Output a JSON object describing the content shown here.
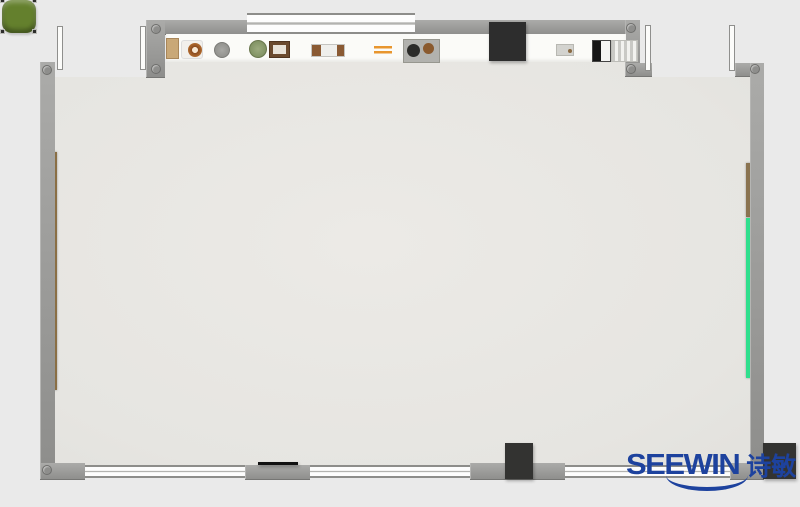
{
  "logo": {
    "text": "SEEWIN",
    "cn": "诗敏",
    "color": "#1d429e"
  },
  "palette": {
    "outside": "#eaeaea",
    "floor": "#e8e7e3",
    "wall": "#9a9a98",
    "window": "#fdfdfd",
    "shelf": "#fbfbf8",
    "cabinet": "#2d2d2d",
    "pillar": "#333331",
    "chair_green": "#64802d",
    "chair_blue": "#5886b5",
    "desk_beige": "#e6cfa7",
    "desk_white": "#f8f8f5",
    "board_brown": "#8a6f45",
    "board_green": "#2fdf8d",
    "l_desk_line": "#c9923f"
  },
  "structure": {
    "floor": {
      "x": 55,
      "y": 58,
      "w": 695,
      "h": 410,
      "clip": "polygon(0 19px,91px 19px,91px 4px,570px 4px,570px 19px,695px 19px,695px 408px,0 408px)"
    },
    "walls": [
      {
        "name": "top-wall",
        "x": 148,
        "y": 20,
        "w": 492,
        "h": 15
      },
      {
        "name": "top-left-corner-wall",
        "x": 146,
        "y": 20,
        "w": 19,
        "h": 58
      },
      {
        "name": "left-wall",
        "x": 40,
        "y": 62,
        "w": 15,
        "h": 418
      },
      {
        "name": "top-right-step-wall-v",
        "x": 625,
        "y": 20,
        "w": 15,
        "h": 57
      },
      {
        "name": "top-right-step-wall-h",
        "x": 625,
        "y": 63,
        "w": 27,
        "h": 14
      },
      {
        "name": "top-right-corner-wall",
        "x": 735,
        "y": 63,
        "w": 29,
        "h": 14
      },
      {
        "name": "right-wall",
        "x": 750,
        "y": 63,
        "w": 14,
        "h": 417
      },
      {
        "name": "bottom-left-corner-wall",
        "x": 40,
        "y": 463,
        "w": 45,
        "h": 17
      },
      {
        "name": "bottom-mid-wall",
        "x": 245,
        "y": 465,
        "w": 65,
        "h": 15
      },
      {
        "name": "bottom-gray-wall",
        "x": 470,
        "y": 463,
        "w": 95,
        "h": 17
      },
      {
        "name": "bottom-right-wall",
        "x": 730,
        "y": 463,
        "w": 34,
        "h": 17
      }
    ],
    "windows": [
      {
        "name": "top-window",
        "x": 247,
        "y": 13,
        "w": 168,
        "h": 21
      },
      {
        "name": "bottom-window-1",
        "x": 85,
        "y": 465,
        "w": 160,
        "h": 13
      },
      {
        "name": "bottom-window-2",
        "x": 310,
        "y": 465,
        "w": 160,
        "h": 13
      },
      {
        "name": "bottom-window-3",
        "x": 565,
        "y": 465,
        "w": 165,
        "h": 13
      }
    ],
    "doors": [
      {
        "name": "door-leaf-top-left-a",
        "x": 57,
        "y": 26,
        "w": 6,
        "h": 44
      },
      {
        "name": "door-leaf-top-left-b",
        "x": 140,
        "y": 26,
        "w": 6,
        "h": 44
      },
      {
        "name": "door-leaf-top-right-a",
        "x": 645,
        "y": 25,
        "w": 6,
        "h": 46
      },
      {
        "name": "door-leaf-top-right-b",
        "x": 729,
        "y": 25,
        "w": 6,
        "h": 46
      }
    ],
    "pillars": [
      {
        "name": "wall-cabinet",
        "x": 489,
        "y": 22,
        "w": 37,
        "h": 39,
        "color": "#2d2d2d"
      },
      {
        "name": "bottom-black-column",
        "x": 505,
        "y": 443,
        "w": 28,
        "h": 36,
        "color": "#333331"
      },
      {
        "name": "bottom-right-black-column",
        "x": 763,
        "y": 443,
        "w": 33,
        "h": 36,
        "color": "#333331"
      },
      {
        "name": "bottom-black-strip",
        "x": 258,
        "y": 462,
        "w": 40,
        "h": 3,
        "color": "#111111"
      }
    ],
    "boards": [
      {
        "name": "left-wall-board-brown",
        "x": 52,
        "y": 152,
        "w": 5,
        "h": 238,
        "color": "#8a6f45"
      },
      {
        "name": "right-wall-board-brown",
        "x": 746,
        "y": 163,
        "w": 6,
        "h": 54,
        "color": "#8a7350"
      },
      {
        "name": "right-wall-board-green",
        "x": 746,
        "y": 218,
        "w": 6,
        "h": 160,
        "color": "#2fdf8d"
      }
    ],
    "shelf": {
      "x": 166,
      "y": 34,
      "w": 460,
      "h": 28
    },
    "corner_dots": [
      {
        "x": 47,
        "y": 70
      },
      {
        "x": 156,
        "y": 29
      },
      {
        "x": 156,
        "y": 69
      },
      {
        "x": 631,
        "y": 28
      },
      {
        "x": 631,
        "y": 69
      },
      {
        "x": 755,
        "y": 69
      },
      {
        "x": 47,
        "y": 470
      }
    ]
  },
  "shelf_items": [
    {
      "type": "box-tan",
      "x": 166,
      "y": 38,
      "w": 13,
      "h": 21
    },
    {
      "type": "plate-donut",
      "x": 181,
      "y": 40,
      "w": 22,
      "h": 19
    },
    {
      "type": "disc-gray",
      "x": 214,
      "y": 42,
      "w": 16,
      "h": 16
    },
    {
      "type": "plant-green",
      "x": 249,
      "y": 40,
      "w": 18,
      "h": 18
    },
    {
      "type": "frame-photo",
      "x": 269,
      "y": 41,
      "w": 21,
      "h": 17
    },
    {
      "type": "rolls",
      "x": 311,
      "y": 44,
      "w": 34,
      "h": 13
    },
    {
      "type": "bars-orange",
      "x": 374,
      "y": 46,
      "w": 18,
      "h": 8
    },
    {
      "type": "tray-dark",
      "x": 403,
      "y": 39,
      "w": 37,
      "h": 24
    },
    {
      "type": "tray-small",
      "x": 556,
      "y": 44,
      "w": 18,
      "h": 12
    },
    {
      "type": "device-bw",
      "x": 592,
      "y": 40,
      "w": 19,
      "h": 22
    },
    {
      "type": "radiator",
      "x": 611,
      "y": 40,
      "w": 27,
      "h": 22
    }
  ],
  "teacher": {
    "side_table": {
      "x": 95,
      "y": 248,
      "w": 43,
      "h": 47
    },
    "side_item": {
      "x": 108,
      "y": 261,
      "w": 15,
      "h": 19
    },
    "chair": {
      "x": 68,
      "y": 352,
      "w": 48,
      "h": 45
    },
    "monitor": {
      "x": 129,
      "y": 350,
      "w": 19,
      "h": 35
    },
    "podium": {
      "x": 157,
      "y": 338,
      "w": 11,
      "h": 60
    },
    "crossbar": {
      "x": 146,
      "y": 362,
      "w": 34,
      "h": 9
    },
    "small_item": {
      "x": 136,
      "y": 386,
      "w": 13,
      "h": 7
    },
    "l_desk": {
      "x": 95,
      "y": 395,
      "w": 48,
      "h": 35
    },
    "printer_a": {
      "x": 103,
      "y": 401,
      "w": 15,
      "h": 19
    },
    "printer_b": {
      "x": 116,
      "y": 396,
      "w": 25,
      "h": 31
    }
  },
  "clusters": {
    "columns_x": [
      178,
      303,
      428
    ],
    "rows_y": [
      118,
      285
    ],
    "chair_colors_top": [
      "green",
      "blue"
    ],
    "chair_colors_bottom": [
      "blue",
      "green"
    ],
    "layout": {
      "chair_w": 34,
      "chair_h": 33,
      "chairs": [
        {
          "x": 2,
          "y": 0
        },
        {
          "x": 44,
          "y": 0
        },
        {
          "x": 2,
          "y": 115
        },
        {
          "x": 44,
          "y": 115
        }
      ],
      "desks": [
        {
          "x": -2,
          "y": 34,
          "kind": "beige"
        },
        {
          "x": 40,
          "y": 34,
          "kind": "white"
        },
        {
          "x": -2,
          "y": 74,
          "kind": "white"
        },
        {
          "x": 38,
          "y": 74,
          "kind": "beige"
        }
      ],
      "desk_w": 40,
      "desk_h": 39
    },
    "desk_items": [
      [
        "none",
        "laptop-gray",
        "screen-blue",
        "paper"
      ],
      [
        "photo",
        "tablet-dark",
        "book",
        "none"
      ],
      [
        "papers",
        "book",
        "laptop-gray",
        "paper"
      ],
      [
        "papers",
        "book",
        "photo",
        "laptop-dark"
      ],
      [
        "none",
        "papers",
        "book",
        "laptop-dark"
      ],
      [
        "laptop-open",
        "none",
        "papers",
        "tablet-dark"
      ]
    ]
  },
  "collab": {
    "rings": [
      {
        "cx": 640,
        "cy": 240,
        "rx": 96,
        "ry": 57
      },
      {
        "cx": 630,
        "cy": 303,
        "rx": 88,
        "ry": 53
      }
    ],
    "chairs": [
      {
        "x": 546,
        "y": 214
      },
      {
        "x": 646,
        "y": 214
      },
      {
        "x": 546,
        "y": 256
      },
      {
        "x": 646,
        "y": 256
      },
      {
        "x": 546,
        "y": 298
      },
      {
        "x": 646,
        "y": 298
      }
    ],
    "devices": [
      {
        "type": "tablet-blue",
        "x": 624,
        "y": 216,
        "w": 21,
        "h": 21
      },
      {
        "type": "pad-gray",
        "x": 600,
        "y": 238,
        "w": 27,
        "h": 18
      },
      {
        "type": "laptop-black",
        "x": 577,
        "y": 259,
        "w": 25,
        "h": 28
      },
      {
        "type": "pad-gray",
        "x": 602,
        "y": 287,
        "w": 27,
        "h": 23
      },
      {
        "type": "laptop-white",
        "x": 577,
        "y": 304,
        "w": 27,
        "h": 21
      },
      {
        "type": "phone-color",
        "x": 628,
        "y": 306,
        "w": 15,
        "h": 20
      }
    ]
  }
}
